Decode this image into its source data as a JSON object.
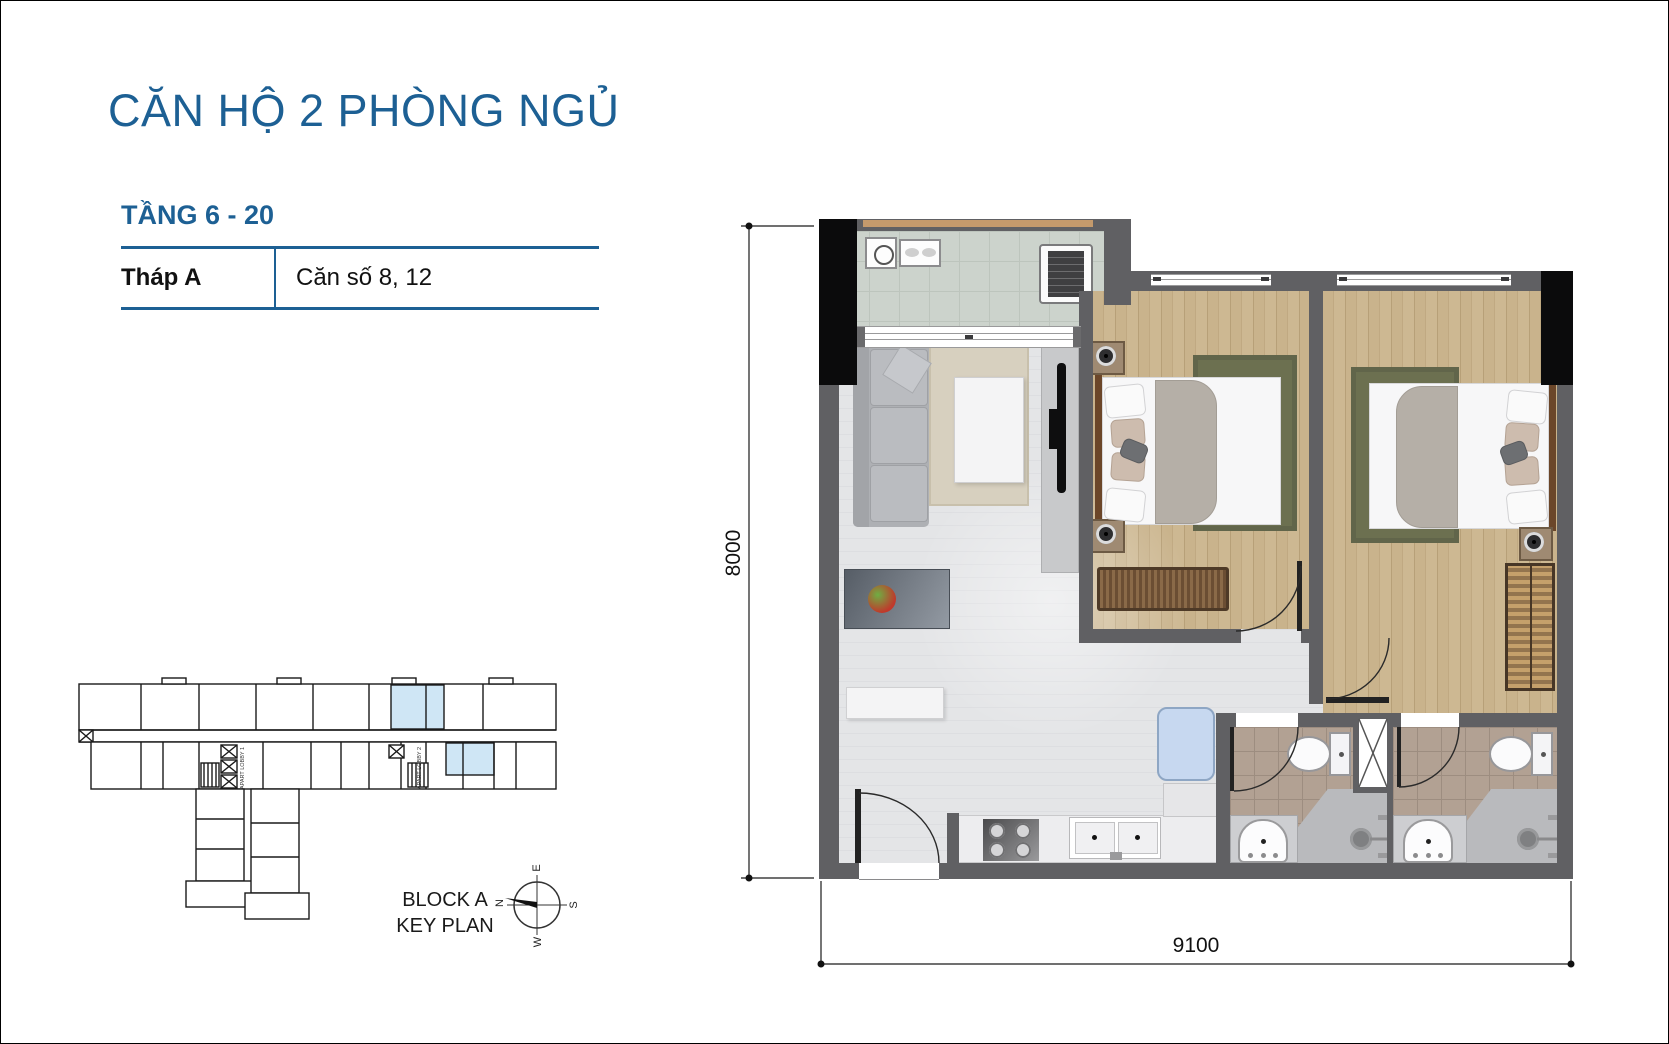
{
  "header": {
    "title": "CĂN HỘ 2 PHÒNG NGỦ"
  },
  "floor_info": {
    "floors": "TẦNG 6 - 20",
    "tower": "Tháp A",
    "units": "Căn số 8, 12"
  },
  "dimensions": {
    "width_label": "9100",
    "height_label": "8000"
  },
  "key_plan": {
    "caption_line1": "BLOCK A",
    "caption_line2": "KEY PLAN",
    "lobby1": "APART LOBBY 1",
    "lobby2": "APART LOBBY 2",
    "compass": {
      "north": "N",
      "east": "E",
      "south": "S",
      "west": "W"
    },
    "highlight_color": "#cfe6f5"
  },
  "colors": {
    "accent_blue": "#1d6094",
    "wall_gray": "#606063",
    "column_black": "#0b0b0c",
    "wood_floor": "#c9b38c",
    "tile_floor": "#e4e5e7",
    "balcony_floor": "#ccd3cc",
    "bath_floor": "#b2a193",
    "rug_olive": "#6c7050",
    "rug_beige": "#d7d0bf",
    "fridge_blue": "#c7d8f0"
  },
  "icons": [
    "compass-icon",
    "washing-machine-icon",
    "drying-rack-icon",
    "ac-unit-icon",
    "tv-icon",
    "fruit-bowl-icon",
    "table-lamp-icon",
    "toilet-icon",
    "basin-sink-icon",
    "shower-head-icon",
    "stove-icon",
    "kitchen-sink-icon",
    "shaft-x-icon",
    "door-arc-icon"
  ]
}
